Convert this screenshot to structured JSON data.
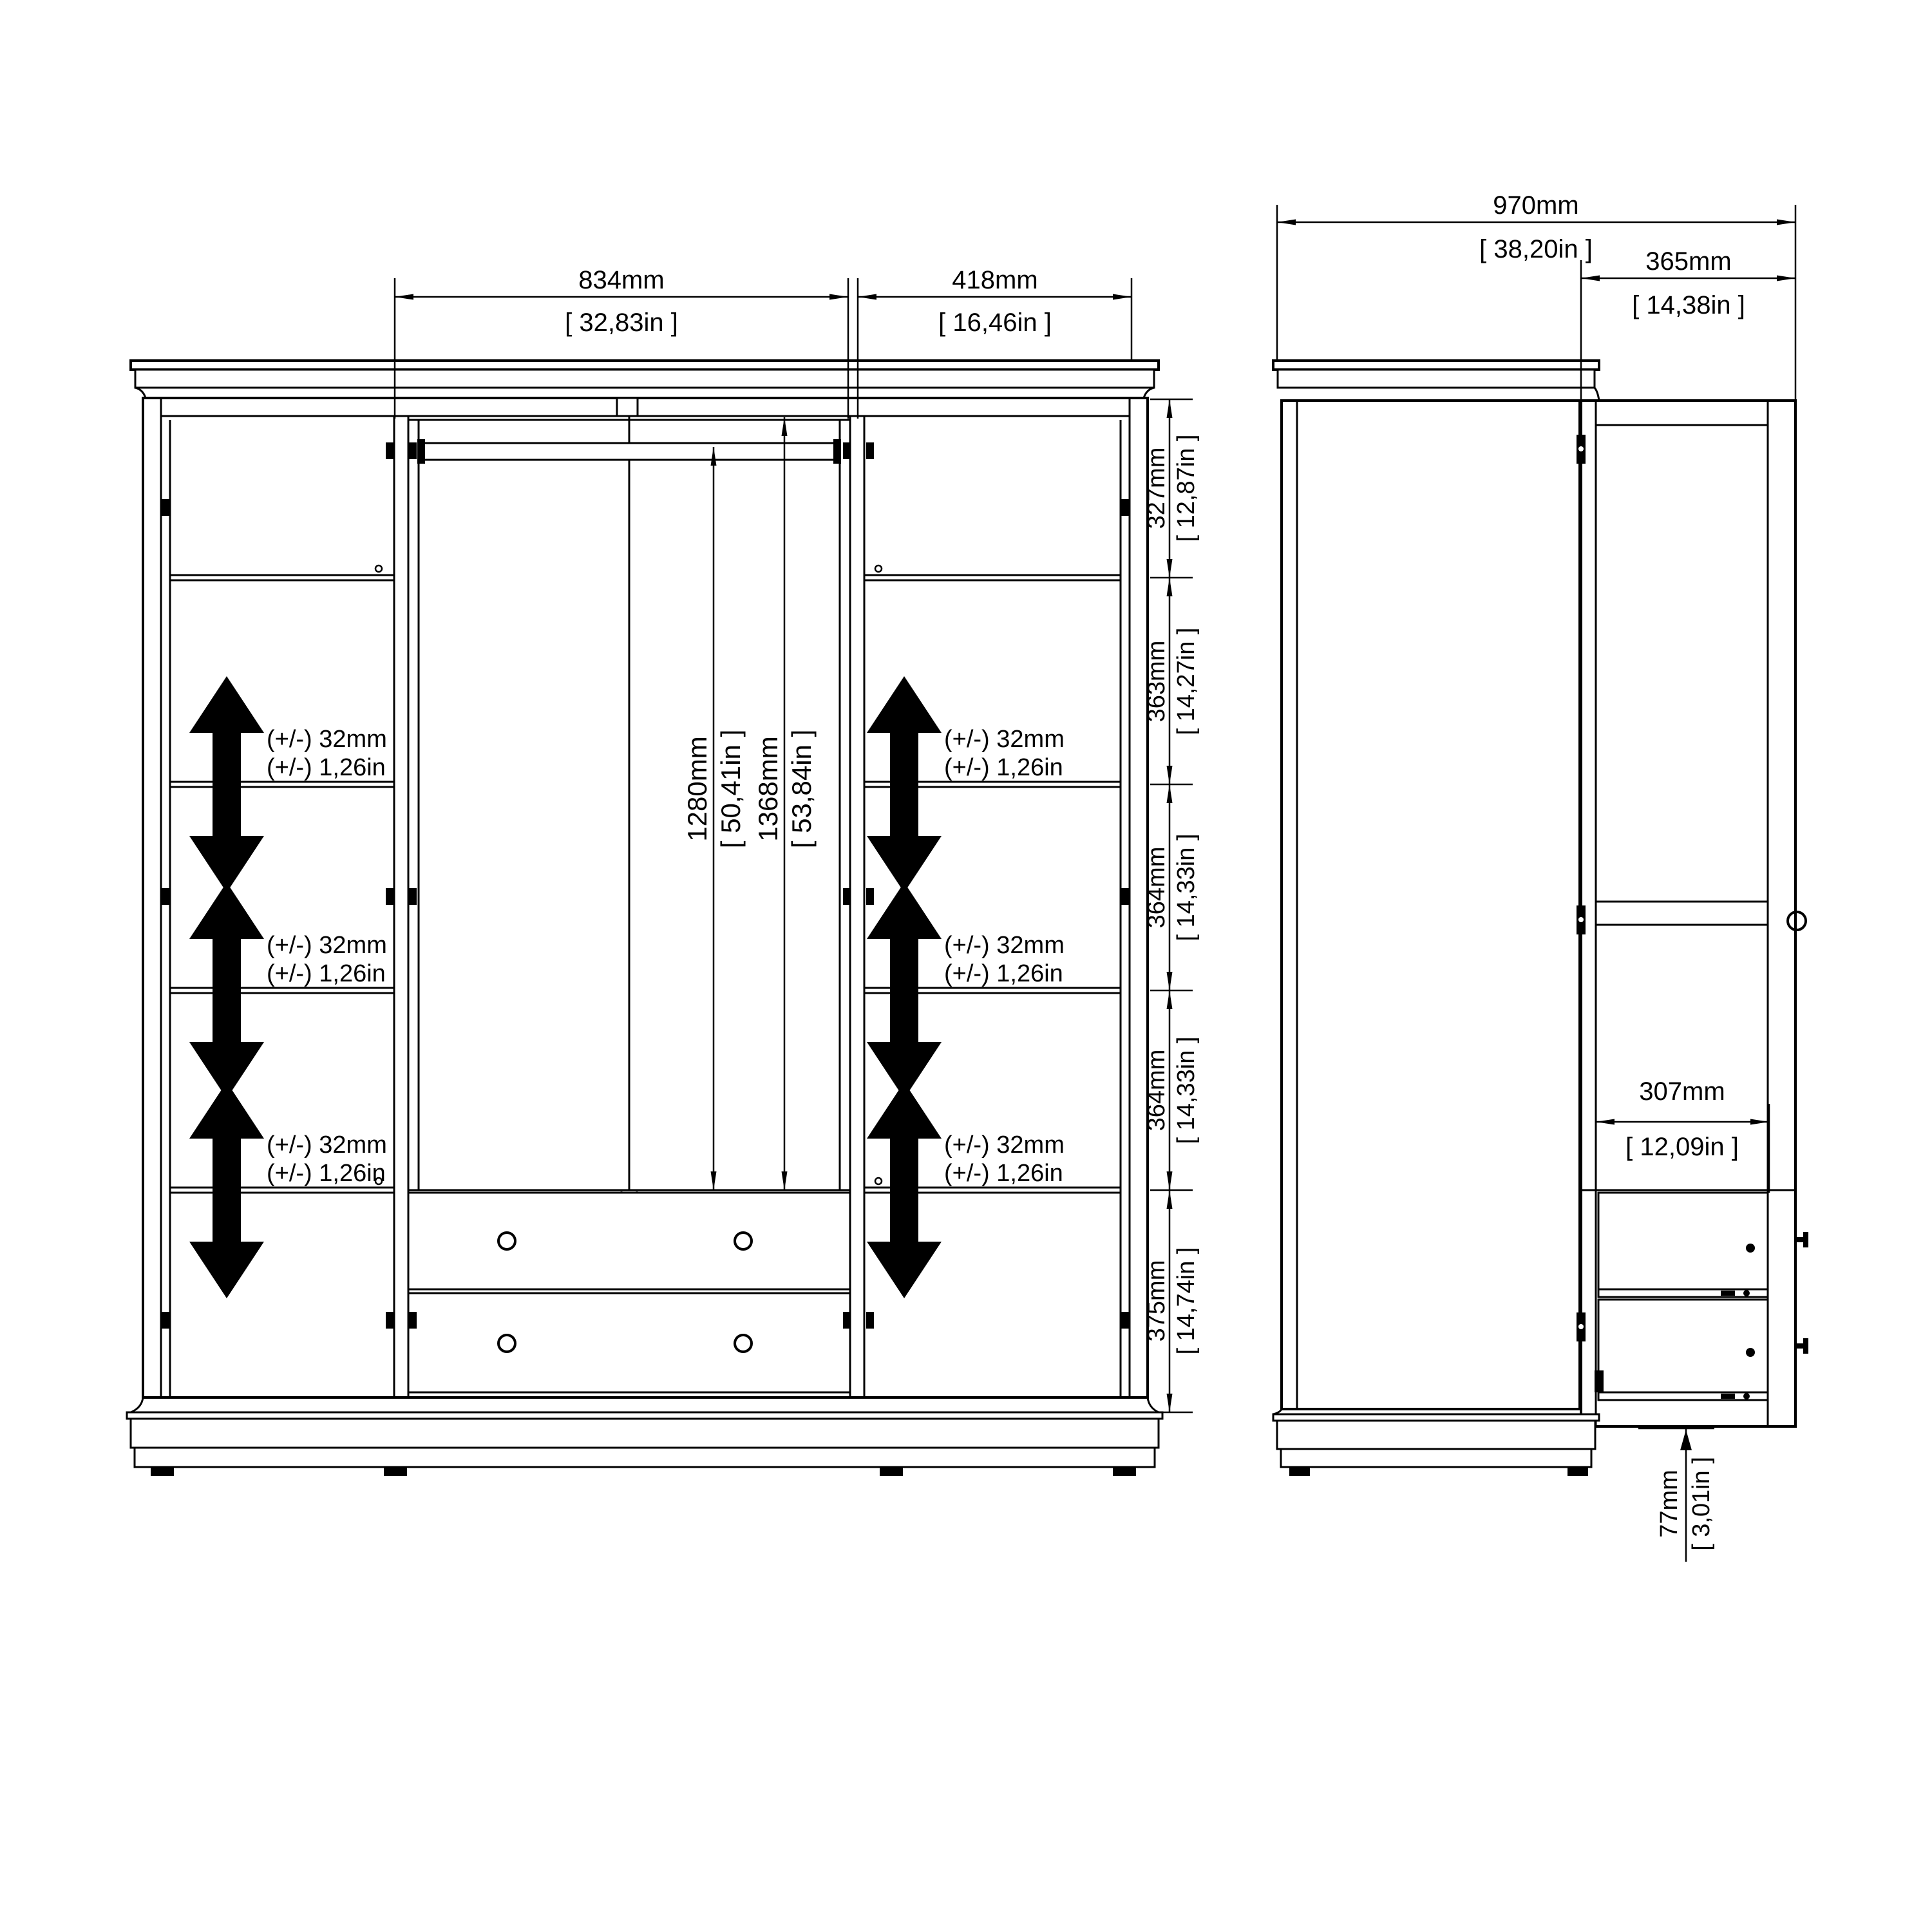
{
  "drawing": {
    "type": "wardrobe technical drawing, front and side elevation with dimensions"
  },
  "front_view": {
    "width_dims": {
      "middle": {
        "mm": "834mm",
        "inch": "[ 32,83in ]"
      },
      "right": {
        "mm": "418mm",
        "inch": "[ 16,46in ]"
      }
    },
    "height_chain": [
      {
        "mm": "327mm",
        "inch": "[ 12,87in ]"
      },
      {
        "mm": "363mm",
        "inch": "[ 14,27in ]"
      },
      {
        "mm": "364mm",
        "inch": "[ 14,33in ]"
      },
      {
        "mm": "364mm",
        "inch": "[ 14,33in ]"
      },
      {
        "mm": "375mm",
        "inch": "[ 14,74in ]"
      }
    ],
    "interior_dims": {
      "rail_to_drawers": {
        "mm": "1280mm",
        "inch": "[ 50,41in ]"
      },
      "top_to_drawers": {
        "mm": "1368mm",
        "inch": "[ 53,84in ]"
      }
    },
    "adjustable": {
      "line1": "(+/-) 32mm",
      "line2": "(+/-) 1,26in"
    }
  },
  "side_view": {
    "depth_dims": {
      "total": {
        "mm": "970mm",
        "inch": "[ 38,20in ]"
      },
      "door": {
        "mm": "365mm",
        "inch": "[ 14,38in ]"
      },
      "drawer": {
        "mm": "307mm",
        "inch": "[ 12,09in ]"
      },
      "plinth": {
        "mm": "77mm",
        "inch": "[ 3,01in ]"
      }
    }
  }
}
